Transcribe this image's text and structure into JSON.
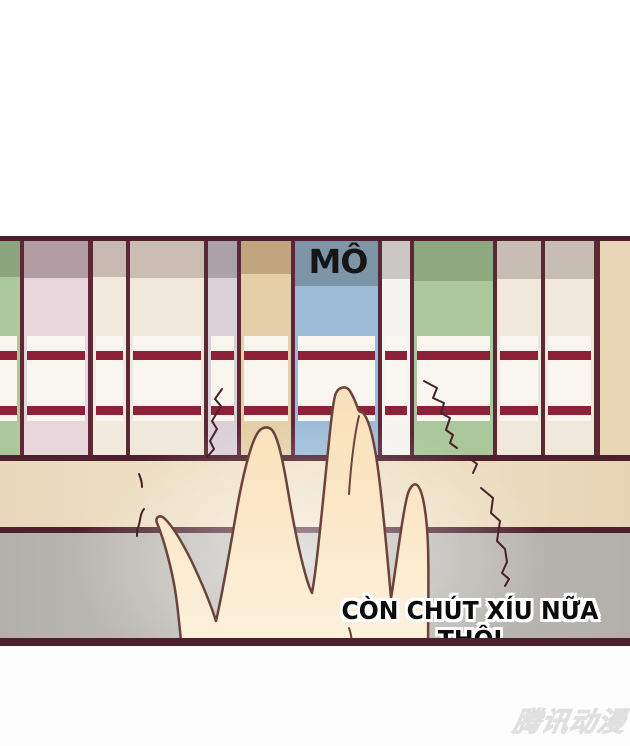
{
  "page": {
    "sfx": "MÔ",
    "caption": "CÒN CHÚT XÍU NỮA THÔI",
    "watermark": "腾讯动漫"
  },
  "colors": {
    "page-bg": "#ffffff",
    "bottom-bg": "#fdfdfd",
    "frame": "#4e202e",
    "divider": "#5c2836",
    "stripe": "#8c2137",
    "label": "#f9f6f0",
    "shelf-strip": "#e9d6b6",
    "tan-band": "#ecdec4",
    "gray-band": "#b6b3ae",
    "hand-fill": "#fbe6c4",
    "hand-stroke": "#6b433c",
    "crack": "#49202b",
    "sfx-color": "#161616",
    "caption-color": "#0c0c0c",
    "watermark-color": "#ececec"
  },
  "spines": [
    {
      "left": 0,
      "width": 20,
      "top": "#8ca57e",
      "bottom": "#abc89c",
      "topH": 36,
      "labelLeft": 0
    },
    {
      "left": 24,
      "width": 64,
      "top": "#b39da5",
      "bottom": "#e9d6dc",
      "topH": 37
    },
    {
      "left": 93,
      "width": 33,
      "top": "#c8bab0",
      "bottom": "#f1eadd",
      "topH": 36
    },
    {
      "left": 130,
      "width": 74,
      "top": "#cabdb1",
      "bottom": "#efe8db",
      "topH": 37
    },
    {
      "left": 208,
      "width": 29,
      "top": "#ada1a9",
      "bottom": "#dbd0d8",
      "topH": 37
    },
    {
      "left": 241,
      "width": 50,
      "top": "#c1a57f",
      "bottom": "#e5cfa8",
      "topH": 33
    },
    {
      "left": 295,
      "width": 83,
      "top": "#7e95a7",
      "bottom": "#9cbcd7",
      "topH": 45
    },
    {
      "left": 382,
      "width": 28,
      "top": "#cbc7c4",
      "bottom": "#f6f4f1",
      "topH": 38
    },
    {
      "left": 414,
      "width": 79,
      "top": "#90a880",
      "bottom": "#abc89c",
      "topH": 40
    },
    {
      "left": 497,
      "width": 44,
      "top": "#c8bdb3",
      "bottom": "#efe7da",
      "topH": 38
    },
    {
      "left": 545,
      "width": 49,
      "top": "#c8bdb3",
      "bottom": "#efe7da",
      "topH": 38
    }
  ],
  "dividers": [
    [
      20,
      4
    ],
    [
      88,
      5
    ],
    [
      126,
      4
    ],
    [
      204,
      4
    ],
    [
      237,
      4
    ],
    [
      291,
      4
    ],
    [
      378,
      4
    ],
    [
      410,
      4
    ],
    [
      493,
      4
    ],
    [
      541,
      4
    ],
    [
      594,
      6
    ]
  ]
}
